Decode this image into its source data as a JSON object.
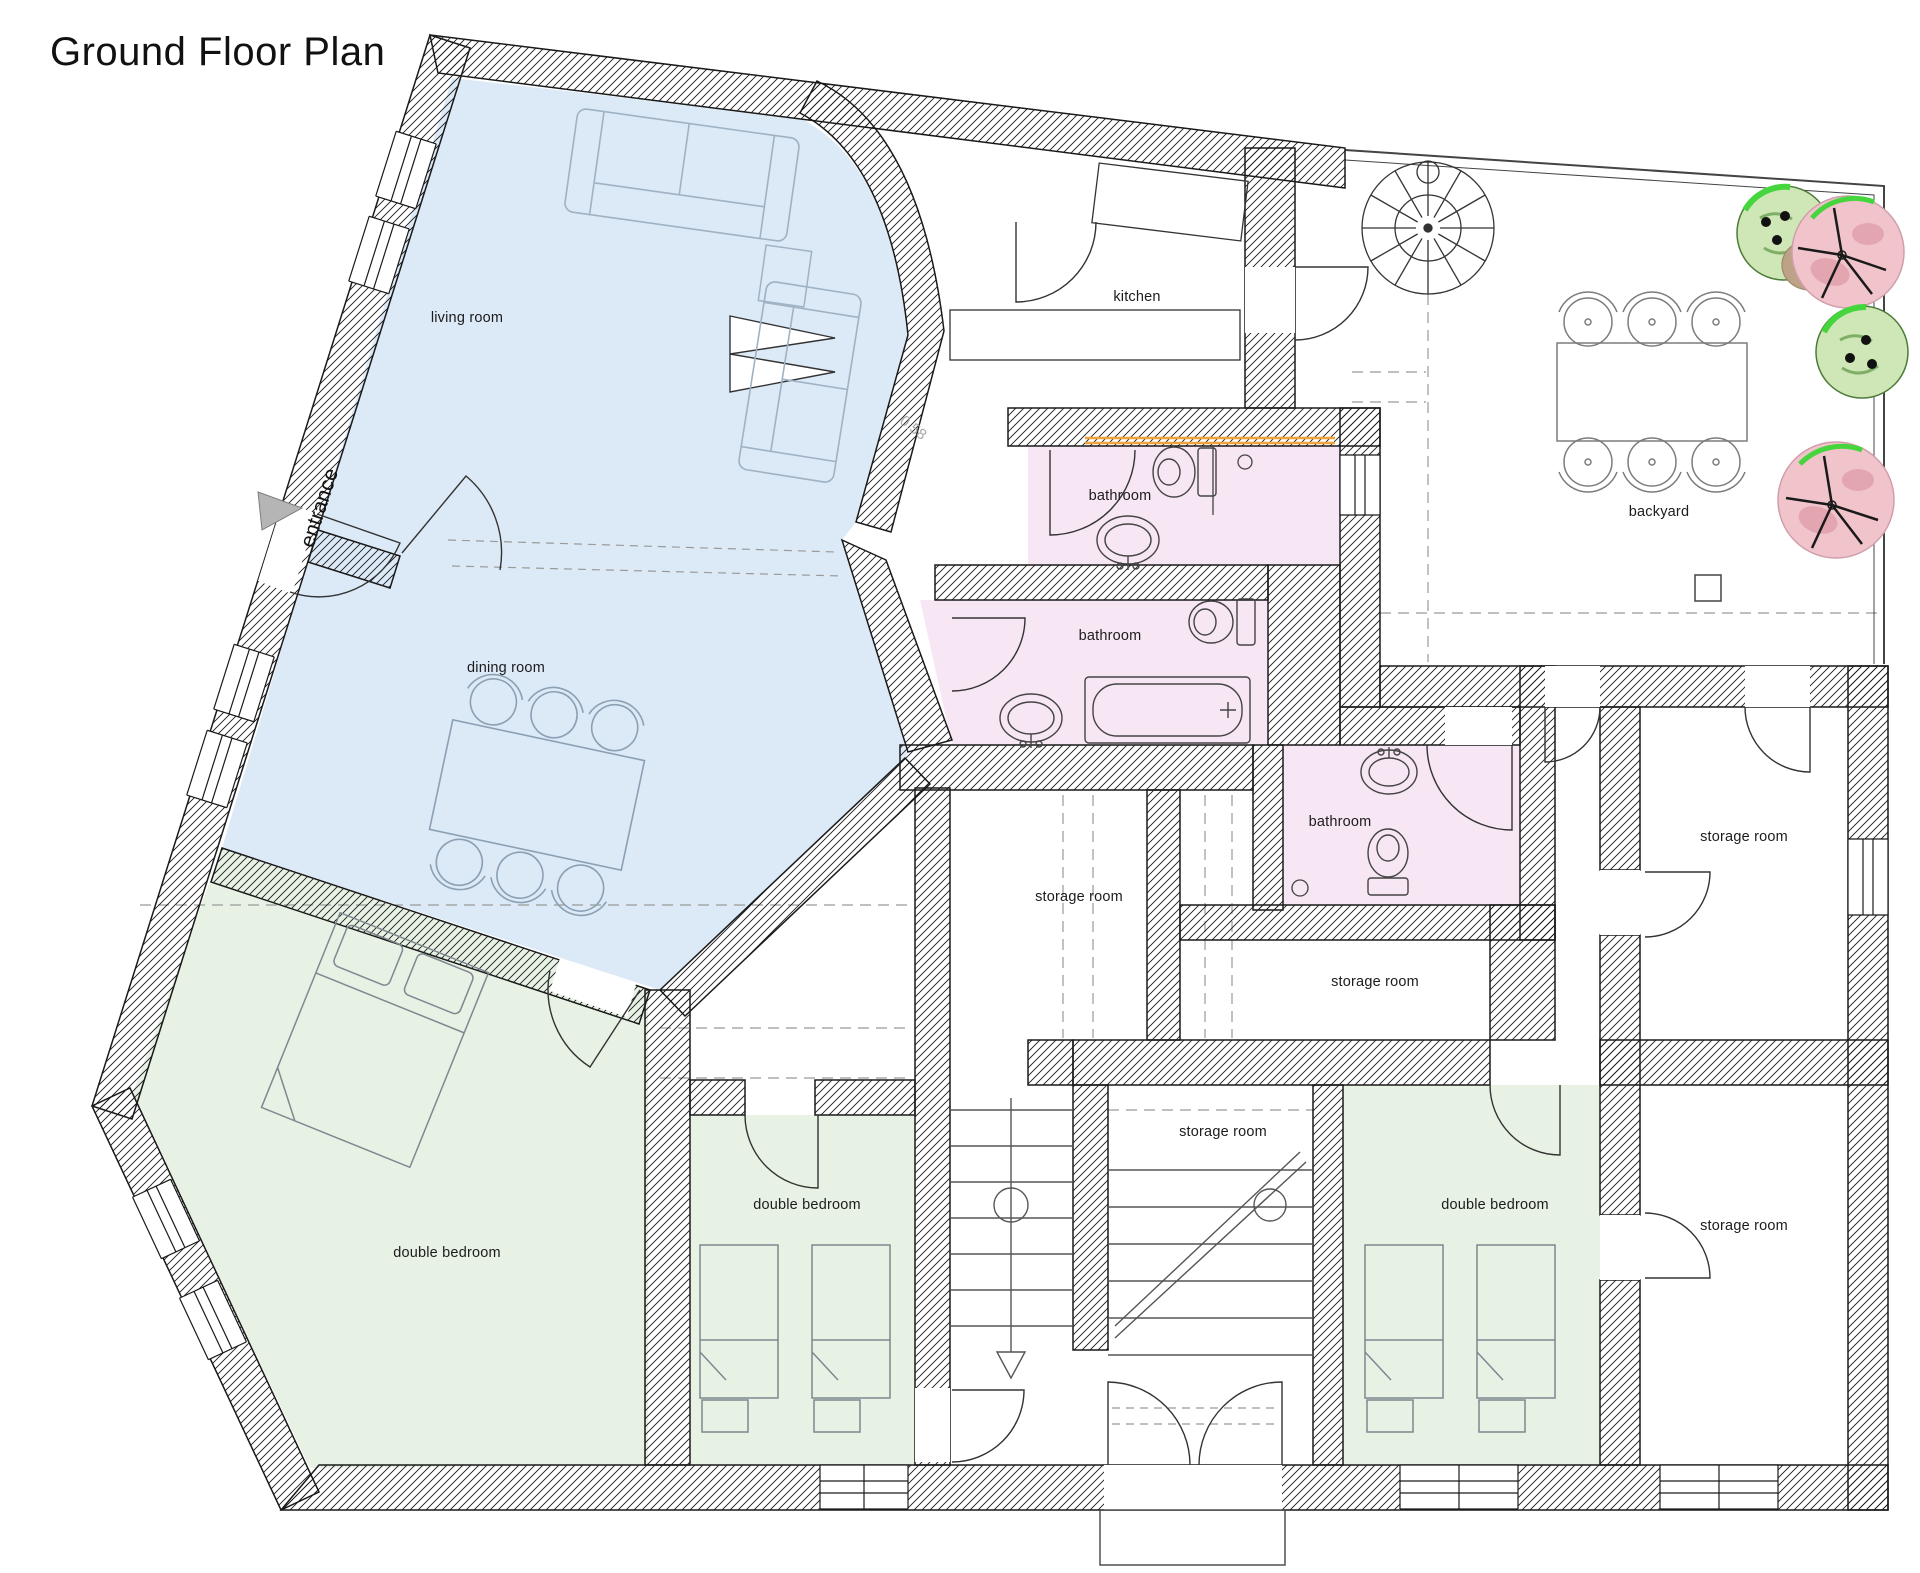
{
  "title": "Ground Floor Plan",
  "annotations": {
    "entrance": "entrance",
    "wall_dimension": "0.58"
  },
  "room_labels": [
    {
      "id": "living-room",
      "text": "living room"
    },
    {
      "id": "dining-room",
      "text": "dining room"
    },
    {
      "id": "kitchen",
      "text": "kitchen"
    },
    {
      "id": "bathroom-upper",
      "text": "bathroom"
    },
    {
      "id": "bathroom-middle",
      "text": "bathroom"
    },
    {
      "id": "bathroom-right",
      "text": "bathroom"
    },
    {
      "id": "backyard",
      "text": "backyard"
    },
    {
      "id": "storage-room-center",
      "text": "storage room"
    },
    {
      "id": "storage-room-mid-right",
      "text": "storage room"
    },
    {
      "id": "storage-room-stairs",
      "text": "storage room"
    },
    {
      "id": "storage-room-upper-right",
      "text": "storage room"
    },
    {
      "id": "storage-room-lower-right",
      "text": "storage room"
    },
    {
      "id": "double-bedroom-left",
      "text": "double bedroom"
    },
    {
      "id": "double-bedroom-center",
      "text": "double bedroom"
    },
    {
      "id": "double-bedroom-right",
      "text": "double bedroom"
    }
  ],
  "palette": {
    "room_blue": "#dce9f6",
    "room_green": "#e7f2e5",
    "room_pink": "#f7e6f4",
    "accent_orange": "#f0a23c",
    "tree_green_fill": "#cfe7b6",
    "tree_pink_fill": "#f1c3cb",
    "tree_highlight_green": "#45d53d",
    "wall_line": "#1a1a1a"
  }
}
